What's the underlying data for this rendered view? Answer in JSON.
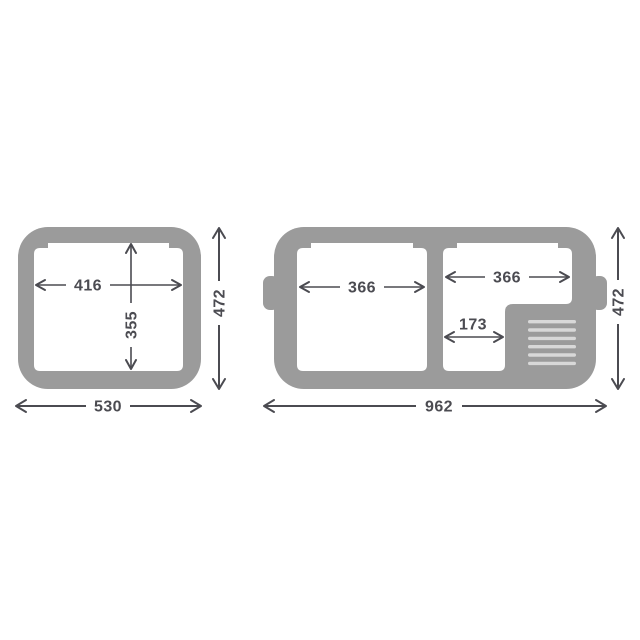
{
  "page": {
    "background": "#ffffff",
    "description": "Top-view dimension drawing of two cooler units"
  },
  "colors": {
    "body_gray": "#9b9b9b",
    "compartment_white": "#ffffff",
    "grille_stripe": "#d8d8d8",
    "dimension_ink": "#4b4b51"
  },
  "diagram": {
    "left_unit": {
      "inner_width": "416",
      "inner_depth": "355",
      "outer_width": "530",
      "outer_depth": "472"
    },
    "right_unit": {
      "left_compartment_width": "366",
      "right_compartment_width": "366",
      "lower_compartment_width": "173",
      "outer_width": "962",
      "outer_depth": "472"
    }
  }
}
